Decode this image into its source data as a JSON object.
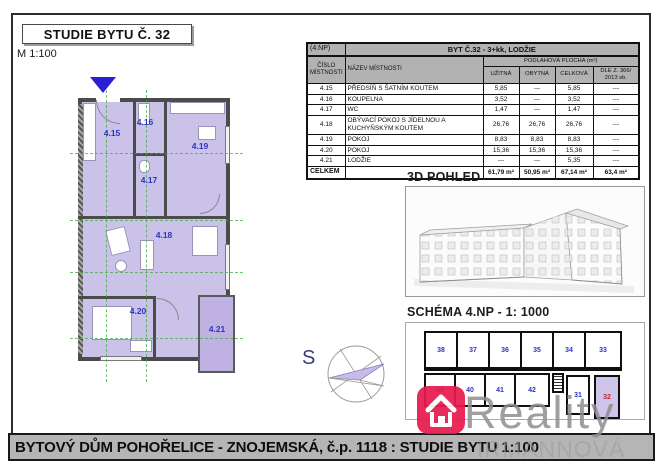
{
  "page": {
    "title": "STUDIE BYTU Č. 32",
    "scale": "M 1:100",
    "footer": "BYTOVÝ DŮM POHOŘELICE - ZNOJEMSKÁ, č.p. 1118 : STUDIE BYTU 1:100"
  },
  "area_table": {
    "floor": "(4.NP)",
    "header_title": "BYT Č.32 - 3+kk, LODŽIE",
    "col_room_no": "ČÍSLO MÍSTNOSTI",
    "col_room_name": "NÁZEV MÍSTNOSTI",
    "col_group": "PODLAHOVÁ PLOCHA (m²)",
    "subcols": [
      "UŽITNÁ",
      "OBYTNÁ",
      "CELKOVÁ",
      "DLE Z. 366/ 2013 sb."
    ],
    "rows": [
      [
        "4.15",
        "PŘEDSÍŇ S ŠATNÍM KOUTEM",
        "5,85",
        "---",
        "5,85",
        "---"
      ],
      [
        "4.16",
        "KOUPELNA",
        "3,52",
        "---",
        "3,52",
        "---"
      ],
      [
        "4.17",
        "WC",
        "1,47",
        "---",
        "1,47",
        "---"
      ],
      [
        "4.18",
        "OBÝVACÍ POKOJ S JÍDELNOU A KUCHYŇSKÝM KOUTEM",
        "26,76",
        "26,76",
        "26,76",
        "---"
      ],
      [
        "4.19",
        "POKOJ",
        "8,83",
        "8,83",
        "8,83",
        "---"
      ],
      [
        "4.20",
        "POKOJ",
        "15,36",
        "15,36",
        "15,36",
        "---"
      ],
      [
        "4.21",
        "LODŽIE",
        "---",
        "---",
        "5,35",
        "---"
      ]
    ],
    "total_label": "CELKEM",
    "totals": [
      "61,79 m²",
      "50,95 m²",
      "67,14 m²",
      "63,4 m²"
    ]
  },
  "floorplan": {
    "rooms": [
      "4.15",
      "4.16",
      "4.17",
      "4.18",
      "4.19",
      "4.20",
      "4.21"
    ],
    "north_label": "S"
  },
  "view3d": {
    "title": "3D POHLED"
  },
  "schema": {
    "title": "SCHÉMA 4.NP - 1: 1000",
    "top_units": [
      "38",
      "37",
      "36",
      "35",
      "34",
      "33"
    ],
    "bottom_units": [
      "39",
      "40",
      "41",
      "42",
      "31",
      "32"
    ],
    "highlighted_unit": "32"
  },
  "watermark": {
    "brand": "Reality",
    "company": "IRMANNOVÁ s.r.o."
  },
  "colors": {
    "room_fill": "#cbc2e9",
    "loggia_fill": "#bfb2e3",
    "wall": "#4b4b4b",
    "header_gray": "#b2b2b2",
    "room_number_blue": "#2b35c5",
    "unit_highlight_red": "#cc2222",
    "logo_red": "#e81a4e",
    "grid_green": "#3fae3f",
    "entry_arrow_blue": "#2a1fd4"
  }
}
